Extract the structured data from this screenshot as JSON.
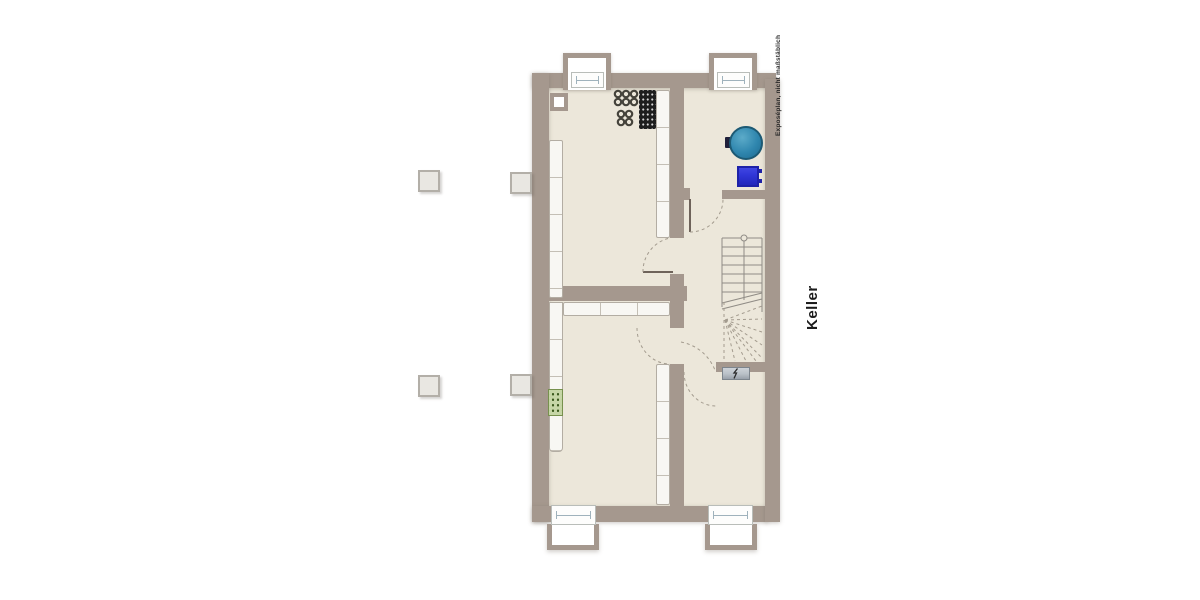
{
  "plan": {
    "floor_label": "Keller",
    "disclaimer": "Exposéplan, nicht maßstäblich",
    "counts": {
      "windows_top": 2,
      "windows_bottom": 2,
      "exterior_shafts": 4,
      "stair_treads": 7,
      "rooms": 4,
      "doors": 4
    },
    "icons": {
      "boiler": "boiler-top-view-icon",
      "expansion_tank": "blue-tank-icon",
      "floor_drain": "green-drain-icon",
      "electrical_panel": "electrical-panel-icon",
      "lightning": "lightning-icon",
      "pipe_rings": "pipe-rings-icon",
      "perforated_panel": "perforated-panel-icon",
      "staircase": "staircase-icon",
      "window": "window-icon",
      "door_swing": "door-swing-arc-icon"
    },
    "colors": {
      "wall": "#a5988e",
      "floor": "#ece7da",
      "shelf": "#f8f7f3",
      "shelf_line": "#c4bfb5",
      "shelf_edge": "#b3ada3",
      "window_frame": "#9fb2bc",
      "window_fill": "#fdfdfc",
      "boiler_fill": "#2f86ae",
      "boiler_edge": "#1d5a74",
      "tank_fill": "#3036d8",
      "tank_edge": "#1e22a8",
      "green_fill": "#c6d6a6",
      "green_dot": "#3c5a1d",
      "green_edge": "#77914e",
      "electric_fill": "#b9c0c7",
      "electric_edge": "#7d858d",
      "stair_line": "#8f8b85",
      "dash": "#a39b8e",
      "door_leaf": "#6e635a",
      "panel_black": "#1e1e1e",
      "panel_dot": "#d6d6d6",
      "ring": "#45433b",
      "shaft_fill": "#e9e7e2",
      "shaft_edge": "#b3afa8",
      "label": "#1c1c1c"
    }
  }
}
